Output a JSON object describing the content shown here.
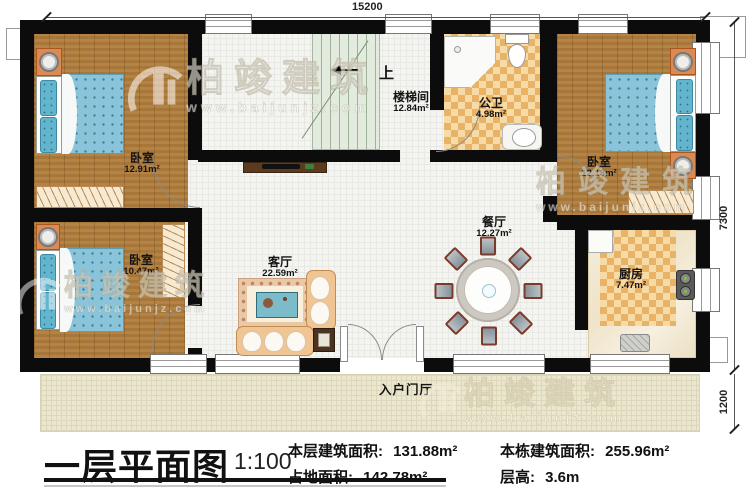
{
  "rooms": [
    {
      "id": "bedroom-top-left",
      "name": "卧室",
      "area": "12.91m²"
    },
    {
      "id": "stairwell",
      "name": "楼梯间",
      "area": "12.84m²",
      "direction": "上"
    },
    {
      "id": "bathroom",
      "name": "公卫",
      "area": "4.98m²"
    },
    {
      "id": "bedroom-top-right",
      "name": "卧室",
      "area": "12.18m²"
    },
    {
      "id": "bedroom-bottom-left",
      "name": "卧室",
      "area": "10.47m²"
    },
    {
      "id": "living-room",
      "name": "客厅",
      "area": "22.59m²"
    },
    {
      "id": "dining-room",
      "name": "餐厅",
      "area": "12.27m²"
    },
    {
      "id": "kitchen",
      "name": "厨房",
      "area": "7.47m²"
    },
    {
      "id": "entry-foyer",
      "name": "入户门厅",
      "area": ""
    }
  ],
  "dimensions": {
    "top": "15200",
    "right_upper": "7300",
    "right_lower": "1200"
  },
  "watermark": {
    "brand": "柏竣建筑",
    "url": "www.baijunjz.com"
  },
  "title_block": {
    "title": "一层平面图",
    "scale": "1:100",
    "stats": [
      {
        "label": "本层建筑面积:",
        "value": "131.88m²"
      },
      {
        "label": "占地面积:",
        "value": "142.78m²"
      },
      {
        "label": "本栋建筑面积:",
        "value": "255.96m²"
      },
      {
        "label": "层高:",
        "value": "3.6m"
      }
    ]
  }
}
